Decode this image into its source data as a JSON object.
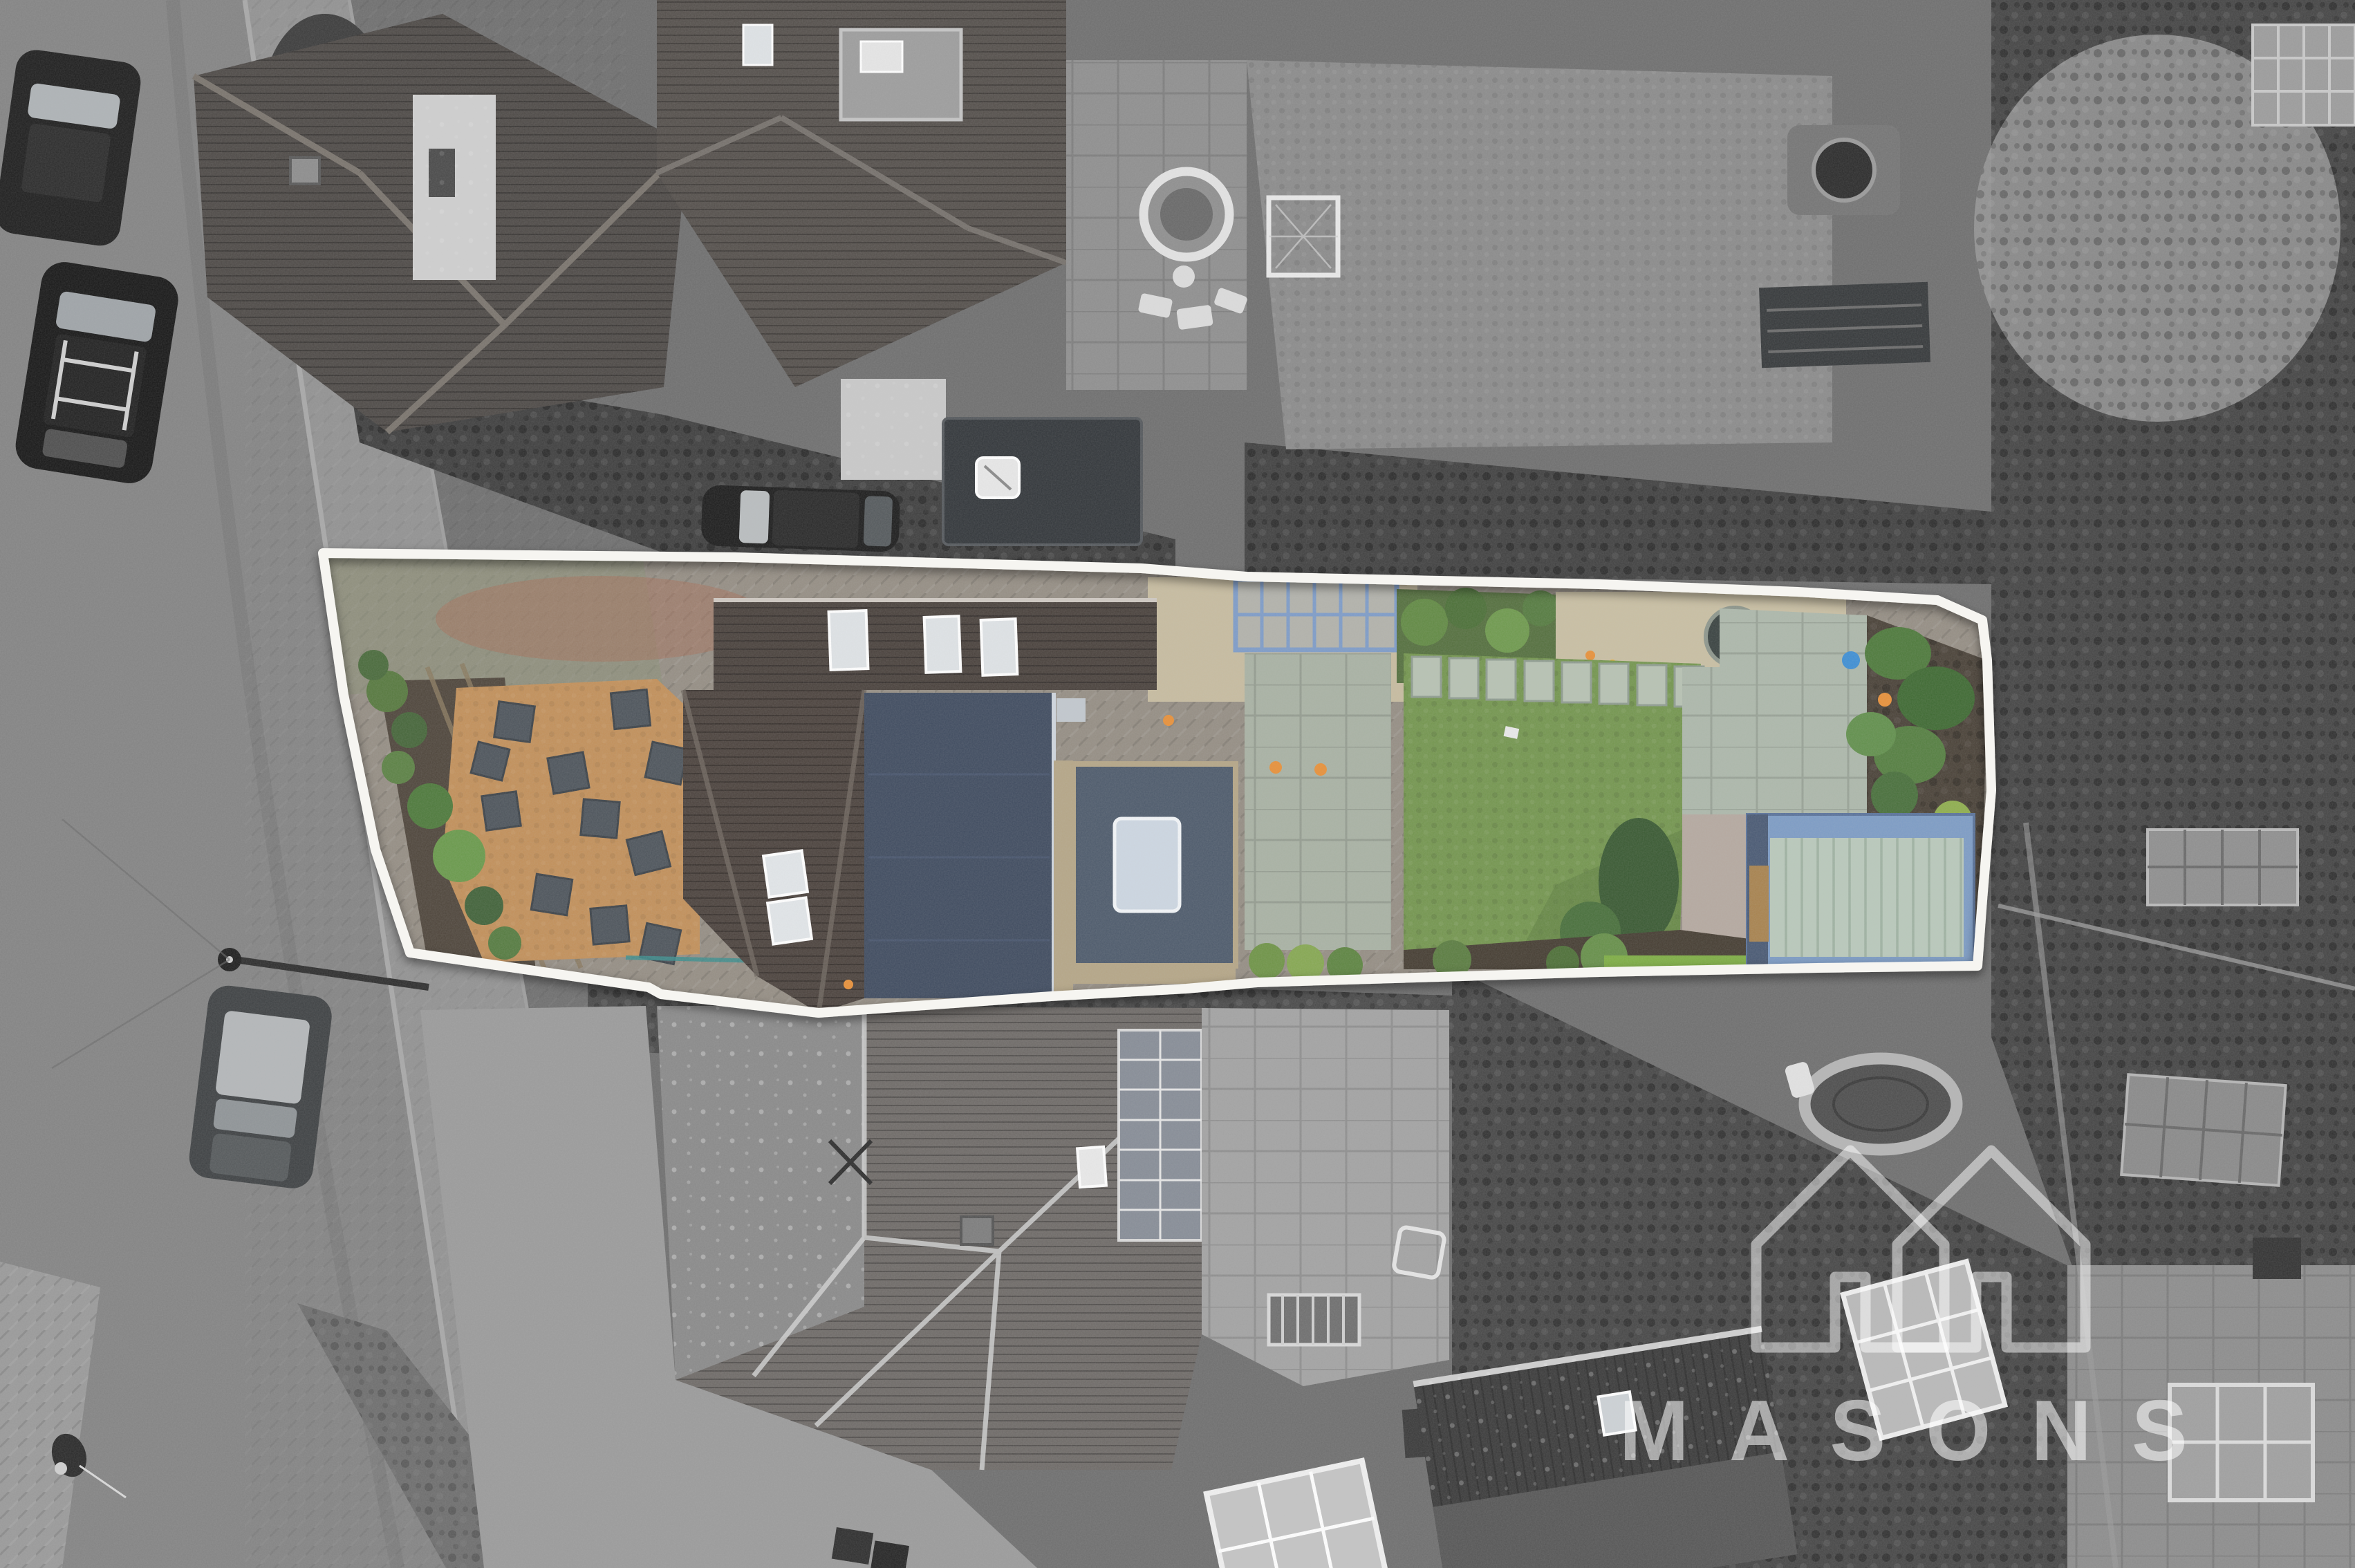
{
  "watermark": {
    "brand": "MASONS",
    "icon": "masons-double-house-logo-icon",
    "color": "rgba(255,255,255,0.55)"
  },
  "annotation": {
    "type": "property-boundary-outline",
    "line_color": "#f6f5f1"
  },
  "palette": {
    "boundary_line": "#f6f5f1",
    "lawn_green": "#74964f",
    "lawn_bright": "#86b14b",
    "mulch_tan": "#c2905a",
    "slate_slab": "#4e555c",
    "roof_brown": "#4a423d",
    "navy_flat_roof": "#404c60",
    "extension_roof": "#4e5b6c",
    "skylight_glass": "#cdd7e2",
    "stone_coping": "#b5a687",
    "pergola_blue": "#7e9cc8",
    "paving_grey_green": "#a9b2a4",
    "stepping_stone": "#b7c2b3",
    "gravel_beige": "#c9bfa3",
    "shed_trim_blue": "#7d9cc5",
    "shed_panel_sage": "#b9c9bb",
    "bush_green": "#4e7a3c",
    "accent_orange": "#e8913a",
    "hose_teal": "#3e8e8e",
    "bucket_blue": "#3f8fd4",
    "road_grey": "#848484",
    "pavement_grey": "#929292",
    "vegetation_dark": "#424242",
    "neighbour_roof_grey": "#6f6b68"
  }
}
